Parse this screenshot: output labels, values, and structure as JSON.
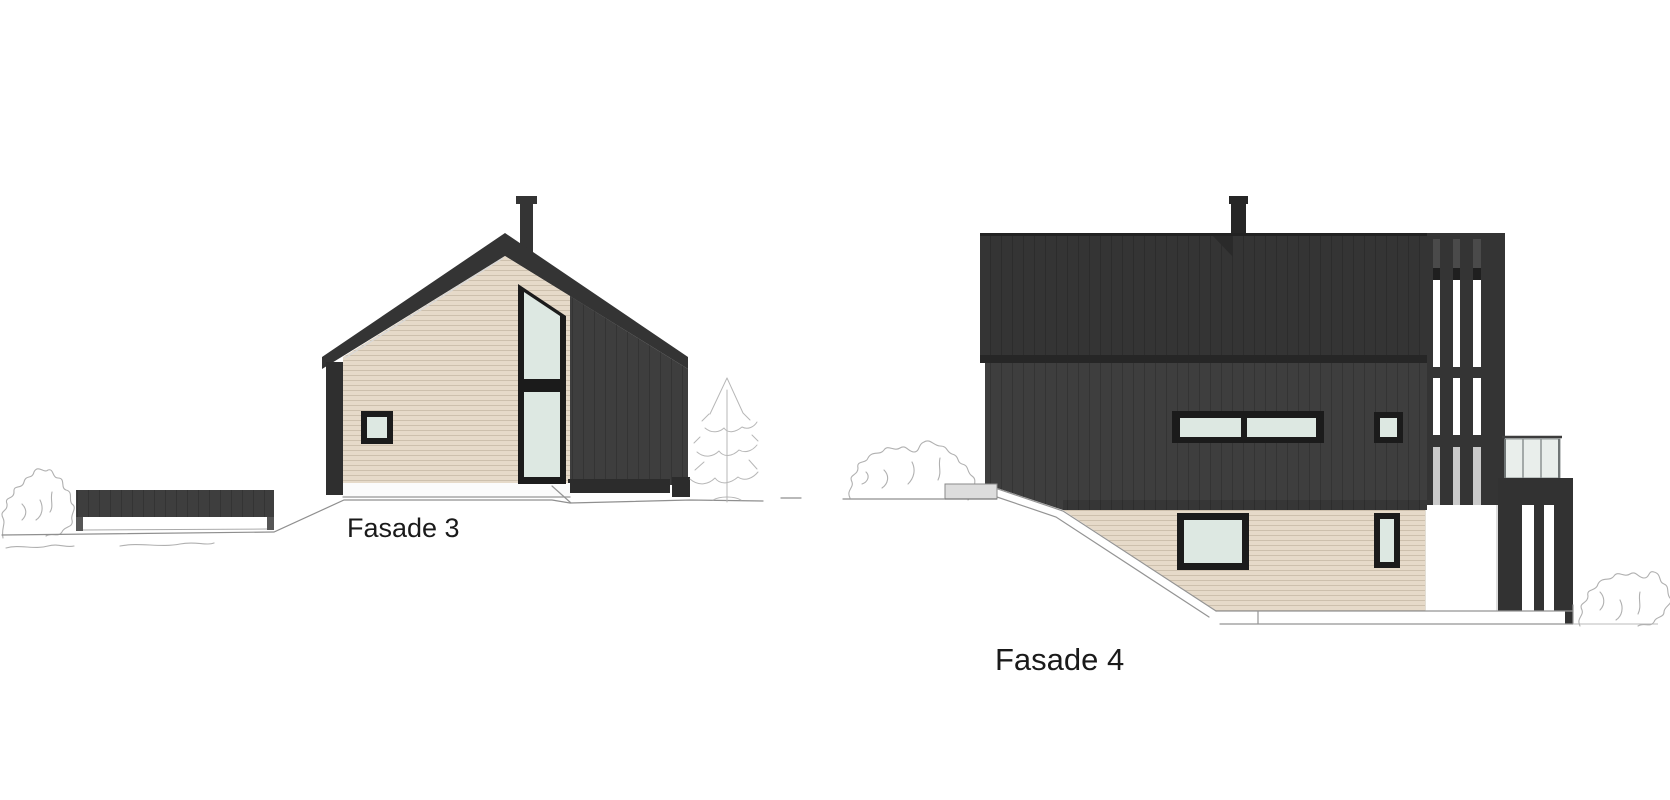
{
  "document": {
    "background_color": "#ffffff",
    "drawings": [
      {
        "id": "fasade3",
        "caption": "Fasade 3",
        "elements": [
          "gabled-roof",
          "chimney",
          "beige-gable-wall",
          "small-square-window",
          "tall-gable-window",
          "dark-side-wall",
          "low-dark-wall",
          "bush-sketch",
          "conifer-tree-sketch",
          "ground-line"
        ]
      },
      {
        "id": "fasade4",
        "caption": "Fasade 4",
        "elements": [
          "flat-dark-roof-band",
          "chimney",
          "dark-main-wall",
          "ribbon-window-two-panes",
          "small-square-window",
          "vertical-slat-screen",
          "glass-balcony-railing",
          "balcony-fascia",
          "under-balcony-slats",
          "beige-basement-wall",
          "basement-window",
          "narrow-basement-window",
          "sloped-foundation-line",
          "bush-sketch-left",
          "bush-sketch-right",
          "ground-line"
        ]
      }
    ]
  },
  "colors": {
    "roof_dark": "#343434",
    "dark_cladding": "#3e3e3e",
    "eave_dark": "#262626",
    "base_strip_dark": "#2c2c2c",
    "balcony_dark": "#323232",
    "window_frame": "#1b1b1b",
    "window_glass": "#dde8e2",
    "beige_cladding": "#e6dac9",
    "railing_glass": "#e9eeeb",
    "slat_gap_white": "#ffffff",
    "slat_gap_shaded": "#c9c9c9",
    "foundation_light": "#dddddd",
    "sketch_vegetation": "#b0b0b0",
    "label_text": "#1a1a1a"
  }
}
